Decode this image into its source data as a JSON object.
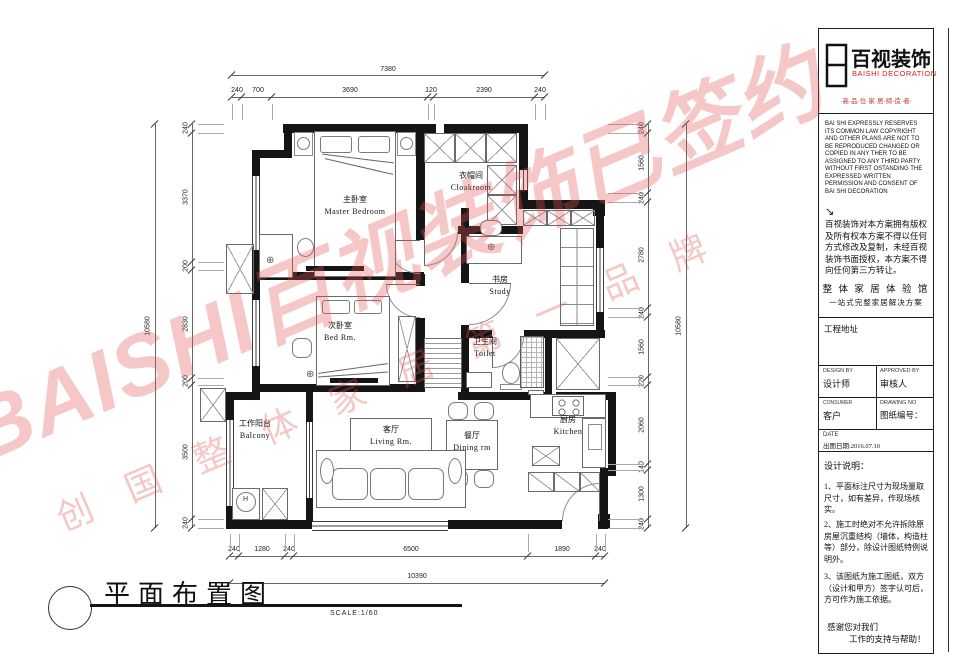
{
  "sheet": {
    "drawing_title": "平面布置图",
    "scale_label": "SCALE:1/60"
  },
  "company": {
    "logo_text": "百视装饰",
    "logo_sub": "BAISHI DECORATION",
    "tagline": "·高·品·位·家·居·缔·造·者·",
    "english_disclaimer": "BAI SHI EXPRESSLY RESERVES ITS COMMON LAW COPYRIGHT AND OTHER PLANS ARE NOT TO BE REPRODUCED CHANGED OR COPIED IN ANY THER TO BE ASSIGNED TO ANY THIRD PARTY WITHOUT FIRST OSTANDING THE EXPRESSED WRITTEN PERMISSION AND CONSENT OF BAI SHI DECORATION",
    "chinese_disclaimer": "百视装饰对本方案拥有版权及所有权本方案不得以任何方式修改及复制，未经百视装饰书面授权，本方案不得向任何第三方转让。",
    "slogan1": "整 体 家 居 体 验 馆",
    "slogan2": "一站式完整家居解决方案",
    "address_label": "工程地址"
  },
  "titleblock": {
    "design_by_en": "DESIGN BY",
    "design_by_cn": "设计师",
    "approved_en": "APPROVED BY",
    "approved_cn": "审核人",
    "consumer_en": "CONSUMER",
    "consumer_cn": "客户",
    "drawing_no_en": "DRAWING NO",
    "drawing_no_cn": "图纸编号：",
    "date_en": "DATE",
    "date_cn": "出图日期:2016.07.10",
    "notes_title": "设计说明：",
    "note1": "1、平面标注尺寸为现场量取尺寸，如有差异，作现场核实。",
    "note2": "2、施工时绝对不允许拆除原房屋沉重结构（墙体，构造柱等）部分，除设计图纸特例说明外。",
    "note3": "3、该图纸为施工图纸，双方（设计和甲方）签字认可后，方可作为施工依据。",
    "thanks1": "感谢您对我们",
    "thanks2": "工作的支持与帮助！"
  },
  "watermark": {
    "line1": "BAISHI百视装饰已签约",
    "line2": "创 国 整 体 家 居 第 一 品 牌",
    "color": "#e25555"
  },
  "rooms": {
    "master": {
      "cn": "主卧室",
      "en": "Master Bedroom"
    },
    "cloakroom": {
      "cn": "衣帽间",
      "en": "Cloakroom"
    },
    "study": {
      "cn": "书房",
      "en": "Study"
    },
    "bedroom2": {
      "cn": "次卧室",
      "en": "Bed Rm."
    },
    "toilet": {
      "cn": "卫生间",
      "en": "Toilet"
    },
    "balcony": {
      "cn": "工作阳台",
      "en": "Balcony"
    },
    "living": {
      "cn": "客厅",
      "en": "Living Rm."
    },
    "dining": {
      "cn": "餐厅",
      "en": "Dining rm"
    },
    "kitchen": {
      "cn": "厨房",
      "en": "Kitchen"
    }
  },
  "dimensions": {
    "top": {
      "total": "7380",
      "segments": [
        "240",
        "700",
        "3690",
        "120",
        "2390",
        "240"
      ]
    },
    "bottom": {
      "total": "10390",
      "segments": [
        "240",
        "1280",
        "240",
        "6500",
        "1890",
        "240"
      ]
    },
    "left": {
      "total": "10580",
      "segments": [
        "240",
        "3370",
        "200",
        "2830",
        "200",
        "3500",
        "240"
      ]
    },
    "right": {
      "total": "10580",
      "segments": [
        "240",
        "1560",
        "240",
        "2780",
        "240",
        "1560",
        "220",
        "2060",
        "140",
        "1300",
        "240"
      ]
    }
  },
  "icons": {
    "center_mark": "⊕",
    "arrow": "↘",
    "washer": "H"
  },
  "colors": {
    "watermark_red": "#e25555",
    "brand_red": "#cc2222",
    "wall_black": "#151515"
  }
}
